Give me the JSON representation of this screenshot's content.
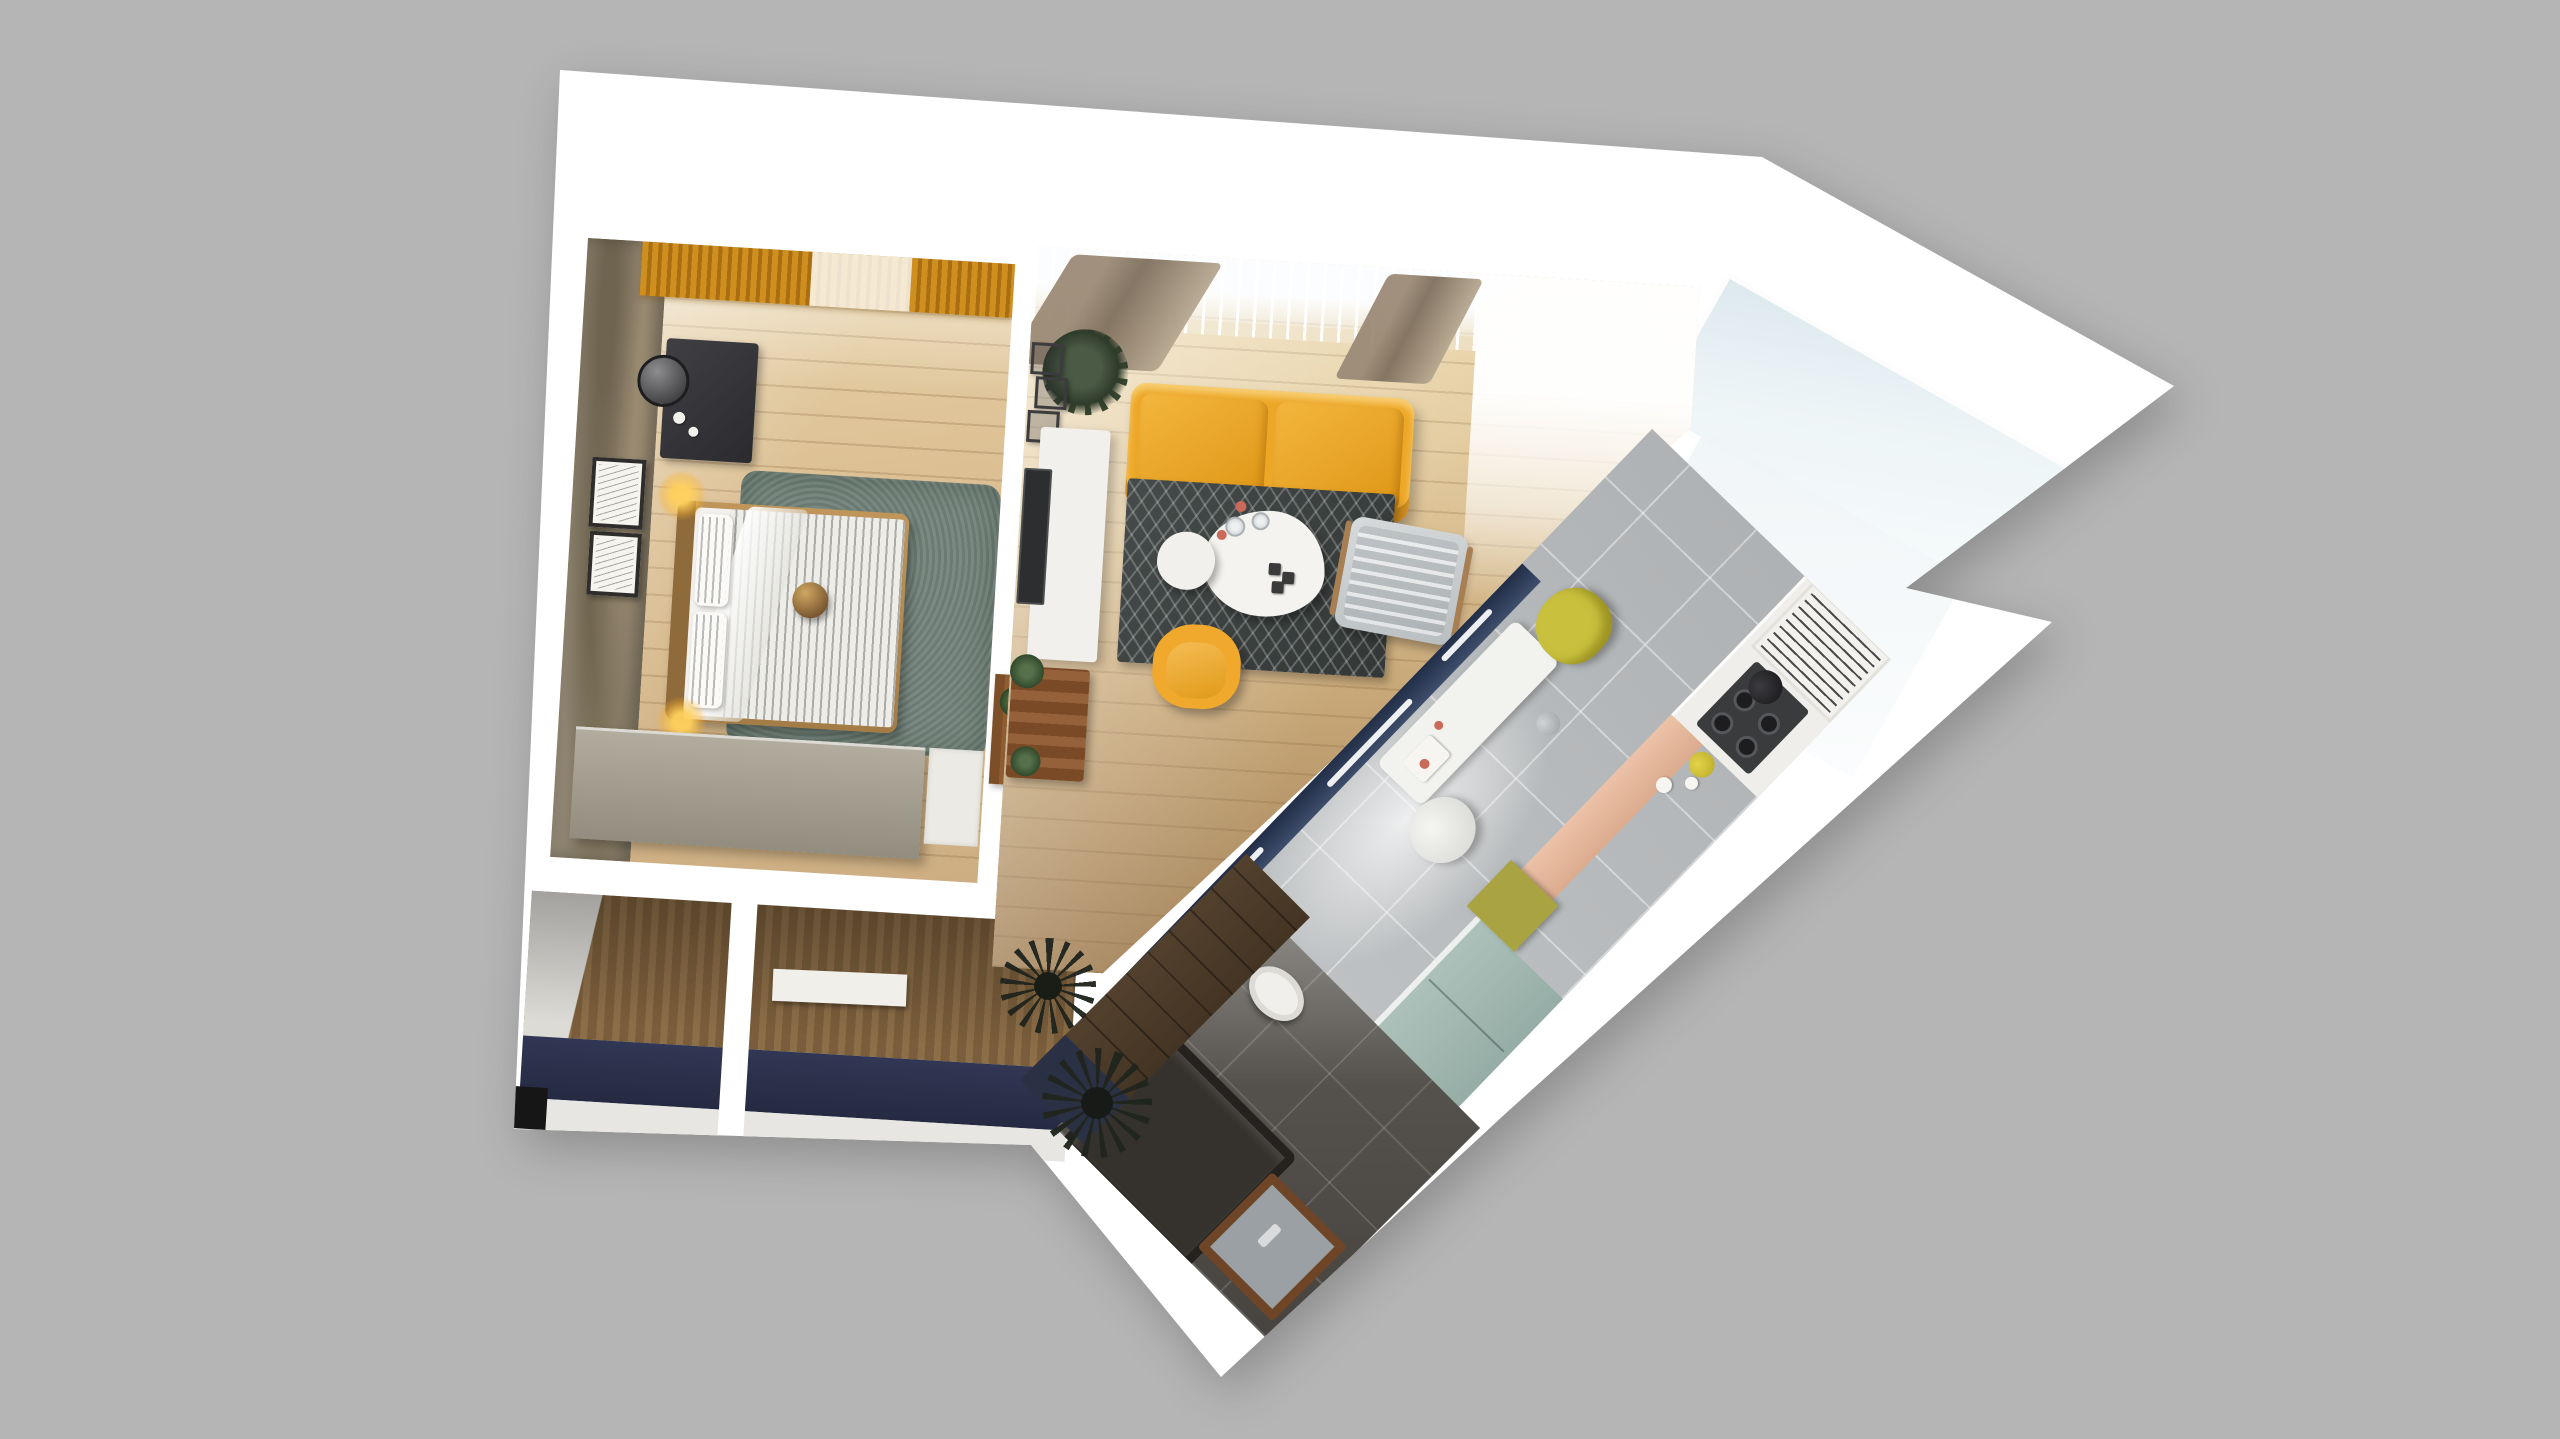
{
  "scene": {
    "description": "3D rendered top-down floor plan of a small one-bedroom apartment on a plain gray background",
    "view": "top-down 3d render, apartment slightly rotated with a diagonal kitchen-bathroom wing",
    "background_color": "#b5b5b5",
    "wall_color": "#ffffff"
  },
  "palette": {
    "bg": "#b5b5b5",
    "walls": "#ffffff",
    "wood_light": "#dcc094",
    "wood_living_dark": "#9d7c54",
    "wood_wenge": "#4b3a2a",
    "rug_green": "#73847b",
    "rug_chevron_dark": "#3a3f3e",
    "sofa_yellow": "#eda727",
    "armchair_yellow": "#f0a82d",
    "chair_chartreuse": "#c9c13d",
    "cabinet_teal": "#a4bab3",
    "cabinet_olive": "#a9a441",
    "backsplash_peach": "#e2b59b",
    "glass_partition_navy": "#32405c",
    "kitchen_tile_gray": "#b7babc",
    "bath_tile_dark": "#56524d",
    "bathtub_dark": "#35312d",
    "entry_floor_navy": "#2f3550",
    "curtain_amber": "#c9891e",
    "curtain_taupe": "#8d7c6a",
    "balcony_glass": "#e8f0f4"
  },
  "rooms": {
    "bedroom": {
      "name": "Bedroom",
      "furniture": [
        "double bed with striped duvet",
        "striped pillows",
        "bronze sphere decor",
        "sage green rug",
        "taupe wardrobe",
        "dark vanity desk",
        "round mirror",
        "glowing bedside lamps",
        "two wall art frames",
        "amber slat curtains",
        "distressed concrete accent wall",
        "light oak plank floor"
      ]
    },
    "living_room": {
      "name": "Living room",
      "furniture": [
        "yellow two-seat sofa",
        "dark chevron rug",
        "white organic coffee tables",
        "drinking glasses and red cups",
        "gray striped lounge chair",
        "yellow armchair",
        "white tv console",
        "wall-mounted tv",
        "black cube wall shelves",
        "large green plant",
        "wooden magazine bench with plants",
        "sheer window curtains",
        "taupe drapes",
        "sunlit oak floor"
      ]
    },
    "kitchen": {
      "name": "Kitchen corridor",
      "furniture": [
        "navy framed glass partition",
        "gray tile floor",
        "white dining table",
        "chartreuse chair",
        "white round chair",
        "gas hob with pan",
        "vertical dish shelf",
        "teal cabinets",
        "olive cabinet",
        "peach backsplash",
        "yellow vase"
      ]
    },
    "bathroom": {
      "name": "Bathroom",
      "furniture": [
        "dark gray bathtub",
        "wood framed sink",
        "white toilet",
        "dark gray tile floor"
      ]
    },
    "entry": {
      "name": "Entry hall and closets",
      "furniture": [
        "wood paneled walls",
        "navy floor",
        "white shelf bench",
        "wooden coat rack with plants",
        "dark fern plants",
        "wenge plank walkway",
        "black corner cabinet"
      ]
    },
    "balcony": {
      "name": "Balcony",
      "furniture": [
        "frosted glass panel",
        "white parapet walls"
      ]
    }
  }
}
